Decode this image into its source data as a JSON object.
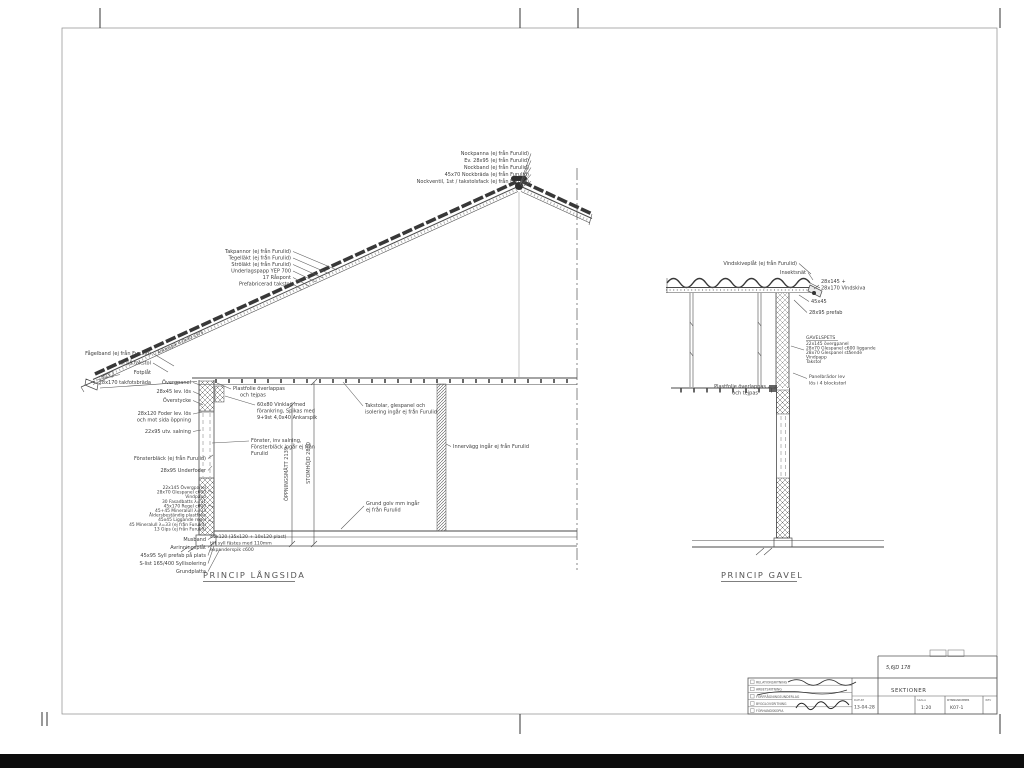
{
  "langsida": {
    "title": "PRINCIP LÅNGSIDA",
    "peak_labels": [
      "Nockpanna (ej från Furulid)",
      "Ev. 28x95 (ej från Furulid)",
      "Nockband (ej från Furulid)",
      "45x70 Nockbräda (ej från Furulid)",
      "Nockventil, 1st / takstolsfack (ej från Furulid)"
    ],
    "roof_labels": [
      "Takpannor (ej från Furulid)",
      "Tegelläkt (ej från Furulid)",
      "Ströläkt (ej från Furulid)",
      "Underlagspapp YEP 700",
      "17 Råspont",
      "Prefabricerad takstol"
    ],
    "rafter_note": "Ankarspik 4,0x40 c375",
    "eave_labels": [
      "Fågelband (ej från Furulid)",
      "Kil på takstol",
      "Fotplåt",
      "28x170 takfotsbräda"
    ],
    "wallhead_labels": [
      "Övergpanel",
      "28x45 lev. lös",
      "Överstycke"
    ],
    "foder_note": [
      "28x120 Foder lev. lös",
      "och mot sida öppning"
    ],
    "salning_note": "22x95 utv. salning",
    "plastfolie_note": [
      "Plastfolie överlappas",
      "och tejpas"
    ],
    "bracket_note": [
      "60x80 Vinklad med",
      "förankring, Spikas med",
      "9+9st 4,0x40 Ankarspik"
    ],
    "window_note": [
      "Fönster, inv salning,",
      "Fönsterbläck ingår ej från",
      "Furulid"
    ],
    "truss_note": [
      "Takstolar, glespanel och",
      "isolering ingår ej från Furulid"
    ],
    "innerwall_note": "Innervägg ingår ej från Furulid",
    "ground_note": [
      "Grund golv mm ingår",
      "ej från Furulid"
    ],
    "dim_opening": "ÖPPNINGSMÅTT 2139",
    "dim_frame": "STOMHÖJD 2800",
    "wall_labels": [
      "Fönsterbläck (ej från Furulid)",
      "28x95 Underfoder",
      "22x145 Övergpanel",
      "28x70 Glespanel c600",
      "Vindpapp",
      "30 Fasadbatts λ=31",
      "45x170 Regel c600",
      "45+45 Mineralull λ=33",
      "Åldersbeständig plastfolie",
      "45x45 Liggande regel",
      "45 Mineralull λ=33 (ej från Furulid)",
      "13 Gips (ej från Furulid)"
    ],
    "base_labels": [
      "Musband",
      "Avrinningsplåt",
      "45x95 Syll prefab på plats",
      "S-list 165/400 Syllisolering",
      "Grundplatta"
    ],
    "sill_note": [
      "45x120 (35x120 + 10x120 plast)",
      "tät syll fästes med 110mm",
      "expanderspik c600"
    ]
  },
  "gavel": {
    "title": "PRINCIP GAVEL",
    "vindskiveplat_note": "Vindskiveplåt (ej från Furulid)",
    "insektsnat_note": "Insektsnät",
    "vindskiva_note": [
      "28x145 +",
      "28x170 Vindskiva"
    ],
    "batten_note": "45x45",
    "prefab_note": "28x95 prefab",
    "gavelspets_note": [
      "GAVELSPETS",
      "22x145 övergpanel",
      "28x70 Glespanel c600 liggande",
      "28x70 Glespanel stående",
      "Vindpapp",
      "Takstol"
    ],
    "panel_note": [
      "Panelbrädor lev",
      "lös i 4 blockstorl"
    ],
    "plastfolie_note": [
      "Plastfolie överlappas",
      "och tejpas"
    ]
  },
  "titleblock": {
    "rows": [
      "RELATIONSRITNING",
      "ARBETSRITNING",
      "FÖRFRÅGNINGSUNDERLAG",
      "BYGGLOVSRITNING",
      "FÖRHANDSKOPIA"
    ],
    "drawing_title": "SEKTIONER",
    "date_label": "DATUM",
    "date_value": "13-04-28",
    "scale_label": "SKALA",
    "scale_value": "1:20",
    "number_label": "RITNINGSNUMMER",
    "number_value": "K07-1",
    "rev_label": "REV",
    "handwritten_note": "5,6JD 178"
  }
}
